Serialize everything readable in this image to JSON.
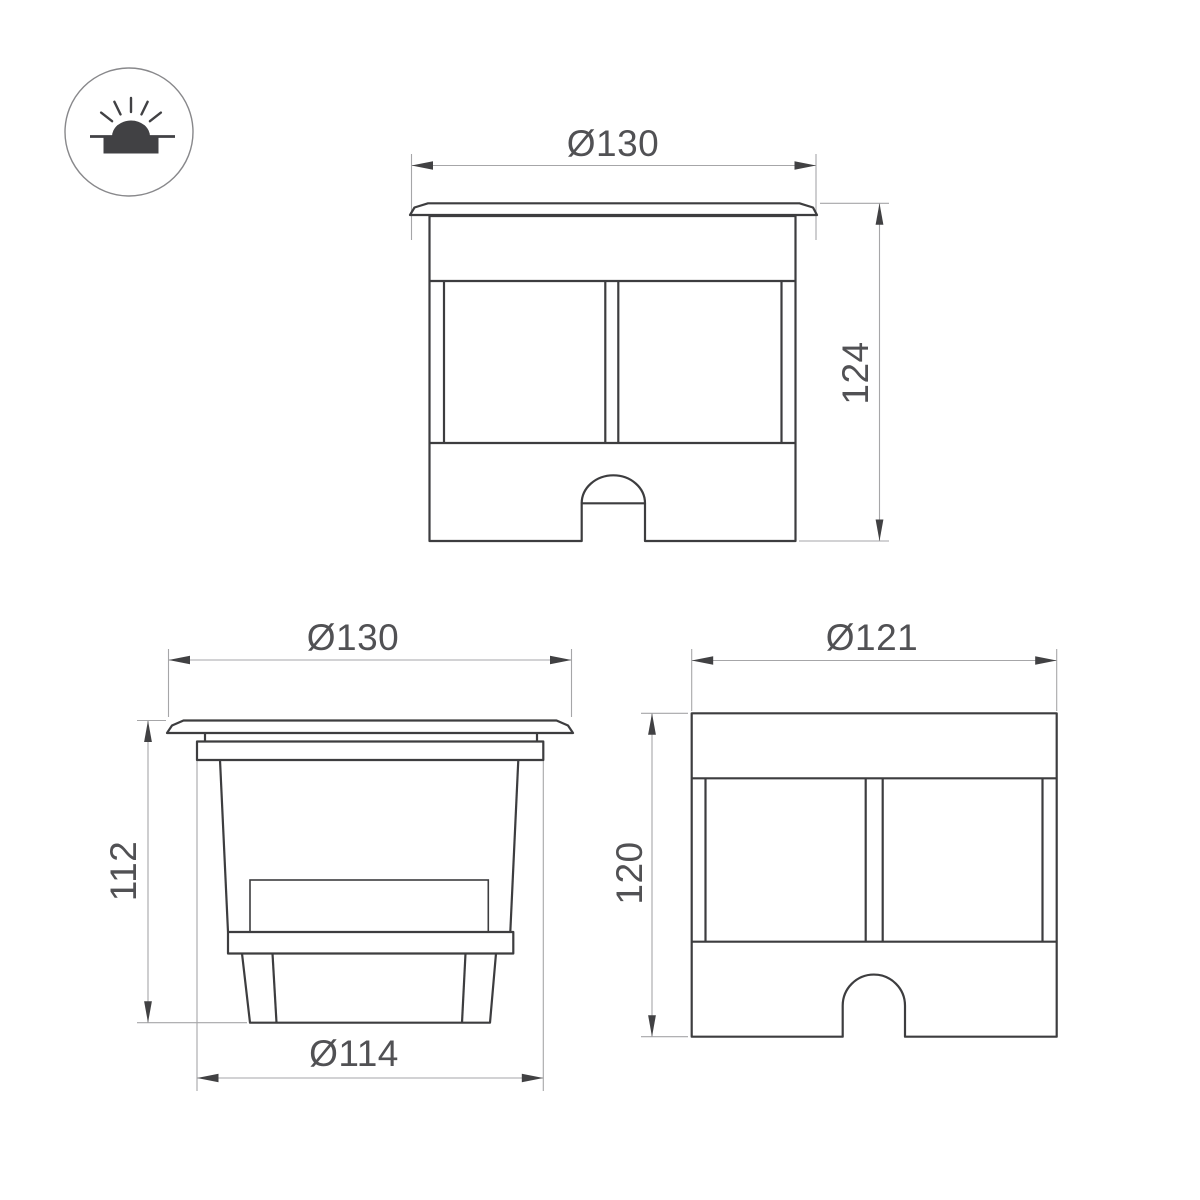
{
  "colors": {
    "outline": "#3d3d3f",
    "dimension_line": "#a6a6a8",
    "arrow": "#414143",
    "text": "#515154",
    "background": "#ffffff",
    "icon": "#414144",
    "icon_circle": "#88888b"
  },
  "logo": {
    "icon": "inground-light-icon"
  },
  "views": {
    "front": {
      "width_dim": "Ø130",
      "height_dim": "124"
    },
    "side": {
      "width_dim": "Ø130",
      "height_dim": "112",
      "base_dim": "Ø114"
    },
    "housing": {
      "width_dim": "Ø121",
      "height_dim": "120"
    }
  }
}
